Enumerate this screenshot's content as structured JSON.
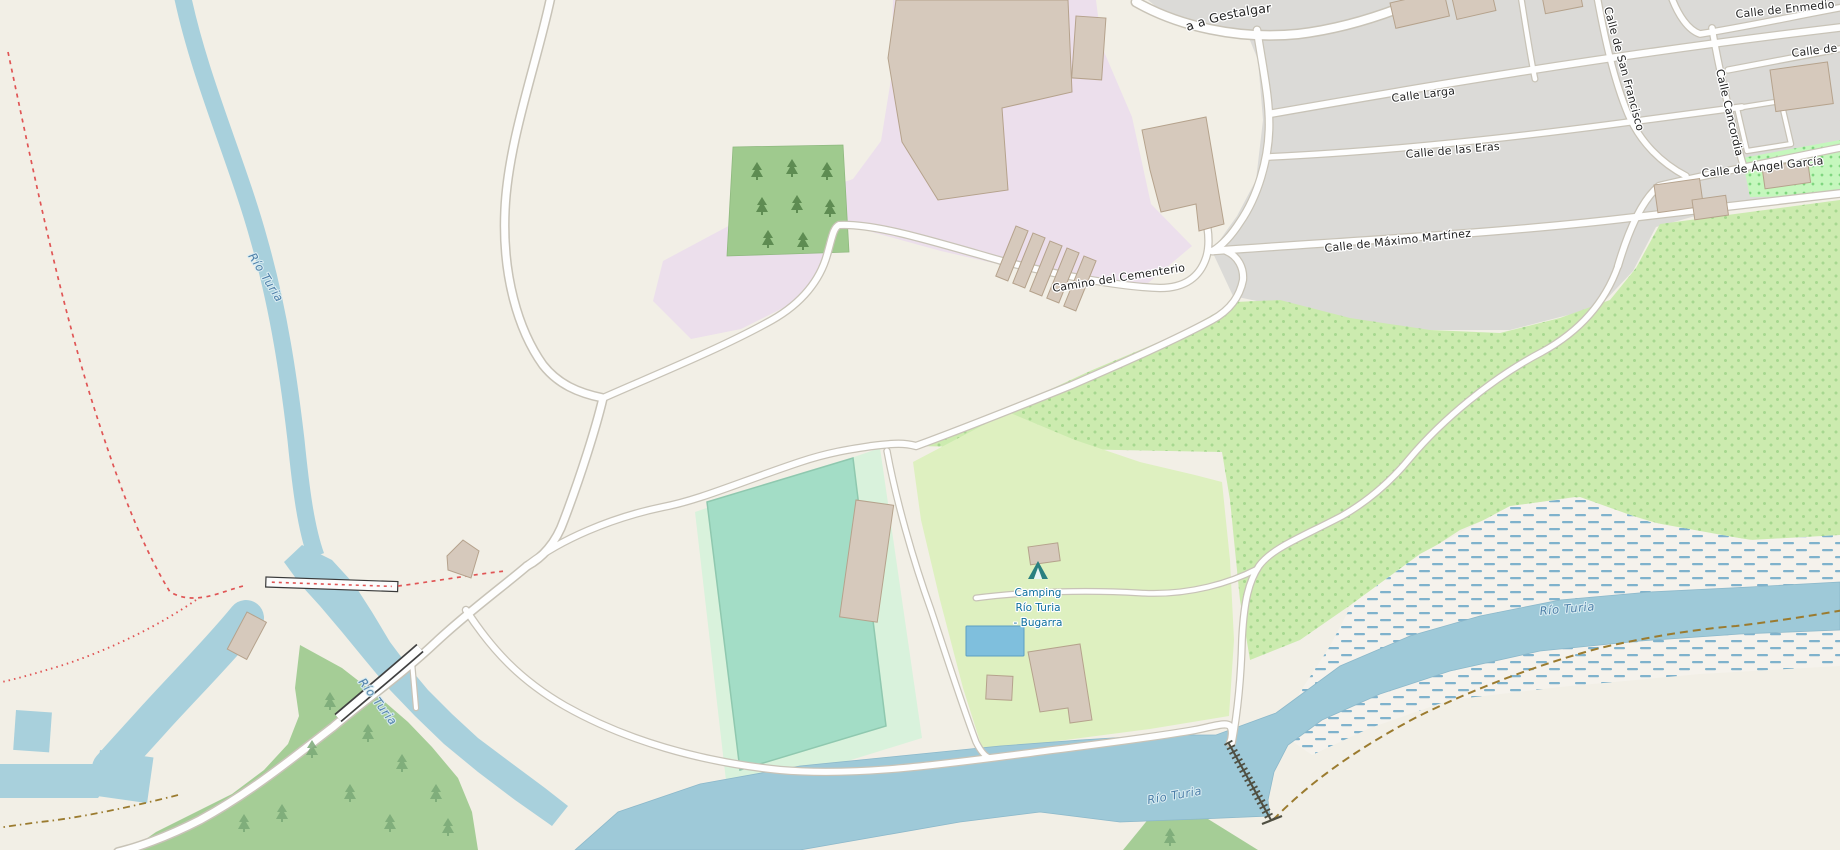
{
  "map": {
    "kind": "openstreetmap-style slippy map, Bugarra (Valencia) area",
    "streets": {
      "gestalgar": "a a Gestalgar",
      "calle_larga": "Calle Larga",
      "calle_de_las_eras": "Calle de las Eras",
      "calle_de_maximo_martinez": "Calle de Máximo Martínez",
      "camino_del_cementerio": "Camino del Cementerio",
      "calle_de_enmedio": "Calle de Enmedio",
      "calle_de_a_truncated": "Calle de A",
      "calle_de_san_francisco": "Calle de San Francisco",
      "calle_cancordia": "Calle Cancordia",
      "calle_de_angel_garcia": "Calle de Ángel García"
    },
    "water_labels": {
      "rio_turia_upper": "Río Turia",
      "rio_turia_lower": "Río Turia",
      "rio_turia_main": "Río Turia",
      "rio_turia_east": "Río Turia"
    },
    "poi": {
      "campsite": {
        "icon": "tent-icon",
        "line1": "Camping",
        "line2": "Río Turia",
        "line3": "- Bugarra"
      }
    },
    "colors": {
      "land": "#f2efe6",
      "residential": "#dbdad7",
      "industrial": "#ecdfec",
      "orchard": "#ccebaf",
      "campsite": "#def0c0",
      "sports_centre": "#d9f2dc",
      "pitch": "#a3ddc6",
      "forest": "#a5cd96",
      "wetland_base": "#f5f2ec",
      "wetland_dash": "#7fb2cc",
      "water": "#a8d0dc",
      "river": "#9ec9d8",
      "pool": "#7fbfdd",
      "building": "#d6c9bc",
      "road_fill": "#fefefe",
      "road_casing": "#c8c3b7",
      "bridge_casing": "#404040",
      "path_red": "#e05555",
      "track_brown": "#9b7b2f",
      "street_text": "#1f1f1f",
      "water_text": "#4d7fa8",
      "poi_text": "#0e6f9e"
    }
  }
}
